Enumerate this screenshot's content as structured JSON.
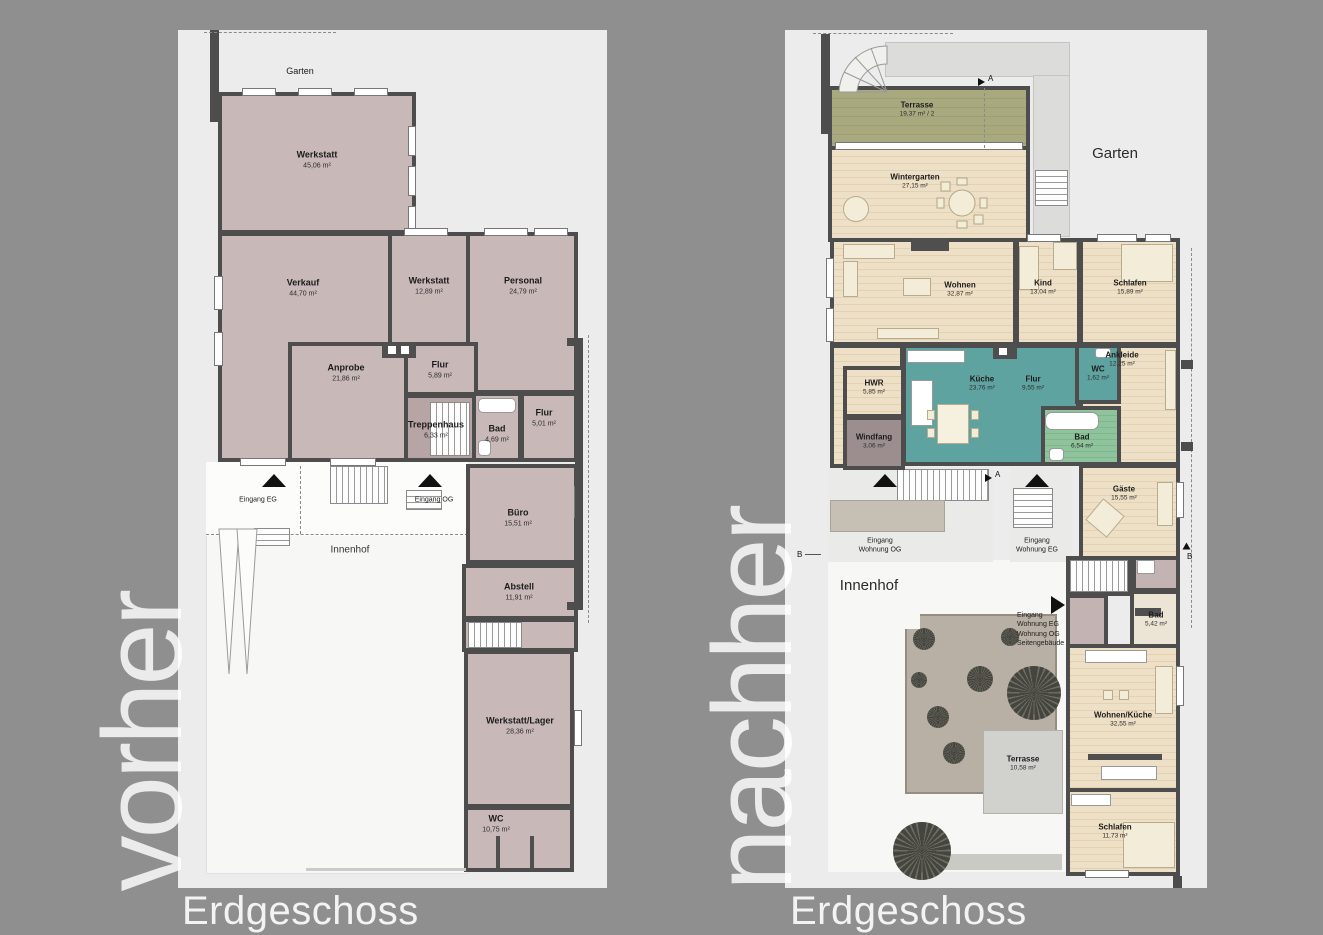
{
  "colors": {
    "background": "#8f8f8f",
    "panel": "#ececec",
    "wall": "#4d4d4d",
    "room_before": "#c8b8b8",
    "wood_floor": "#ecdcc0",
    "kitchen_teal": "#5fa3a1",
    "bath_green": "#82bd92",
    "terrace_olive": "#a6a67c"
  },
  "left": {
    "watermark": "vorher",
    "floor_label": "Erdgeschoss",
    "garten": "Garten",
    "innenhof": "Innenhof",
    "eingang_eg": "Eingang EG",
    "eingang_og": "Eingang OG",
    "rooms": {
      "werkstatt1": {
        "name": "Werkstatt",
        "area": "45,06 m²"
      },
      "verkauf": {
        "name": "Verkauf",
        "area": "44,70 m²"
      },
      "werkstatt2": {
        "name": "Werkstatt",
        "area": "12,89 m²"
      },
      "personal": {
        "name": "Personal",
        "area": "24,79 m²"
      },
      "anprobe": {
        "name": "Anprobe",
        "area": "21,86 m²"
      },
      "flur1": {
        "name": "Flur",
        "area": "5,89 m²"
      },
      "treppenhaus": {
        "name": "Treppenhaus",
        "area": "6,33 m²"
      },
      "bad": {
        "name": "Bad",
        "area": "4,69 m²"
      },
      "flur2": {
        "name": "Flur",
        "area": "5,01 m²"
      },
      "buero": {
        "name": "Büro",
        "area": "15,51 m²"
      },
      "abstell": {
        "name": "Abstell",
        "area": "11,91 m²"
      },
      "werkstatt_lager": {
        "name": "Werkstatt/Lager",
        "area": "28,36 m²"
      },
      "wc": {
        "name": "WC",
        "area": "10,75 m²"
      }
    }
  },
  "right": {
    "watermark": "nachher",
    "floor_label": "Erdgeschoss",
    "garten": "Garten",
    "innenhof": "Innenhof",
    "eingang_og": "Eingang\nWohnung OG",
    "eingang_eg": "Eingang\nWohnung EG",
    "eingang_multi": "Eingang\nWohnung EG\nWohnung OG\nSeitengebäude",
    "section_a": "A",
    "section_b": "B",
    "rooms": {
      "terrasse1": {
        "name": "Terrasse",
        "area": "19,37 m² / 2"
      },
      "wintergarten": {
        "name": "Wintergarten",
        "area": "27,15 m²"
      },
      "wohnen": {
        "name": "Wohnen",
        "area": "32,87 m²"
      },
      "kind": {
        "name": "Kind",
        "area": "13,04 m²"
      },
      "schlafen1": {
        "name": "Schlafen",
        "area": "15,89 m²"
      },
      "ankleide": {
        "name": "Ankleide",
        "area": "12,25 m²"
      },
      "hwr": {
        "name": "HWR",
        "area": "5,85 m²"
      },
      "windfang": {
        "name": "Windfang",
        "area": "3,06 m²"
      },
      "kueche": {
        "name": "Küche",
        "area": "23,76 m²"
      },
      "flur": {
        "name": "Flur",
        "area": "9,55 m²"
      },
      "wc": {
        "name": "WC",
        "area": "1,62 m²"
      },
      "bad1": {
        "name": "Bad",
        "area": "6,54 m²"
      },
      "gaeste": {
        "name": "Gäste",
        "area": "15,55 m²"
      },
      "bad2": {
        "name": "Bad",
        "area": "5,42 m²"
      },
      "wohnen_kueche": {
        "name": "Wohnen/Küche",
        "area": "32,55 m²"
      },
      "schlafen2": {
        "name": "Schlafen",
        "area": "11,73 m²"
      },
      "terrasse2": {
        "name": "Terrasse",
        "area": "10,58 m²"
      }
    }
  }
}
